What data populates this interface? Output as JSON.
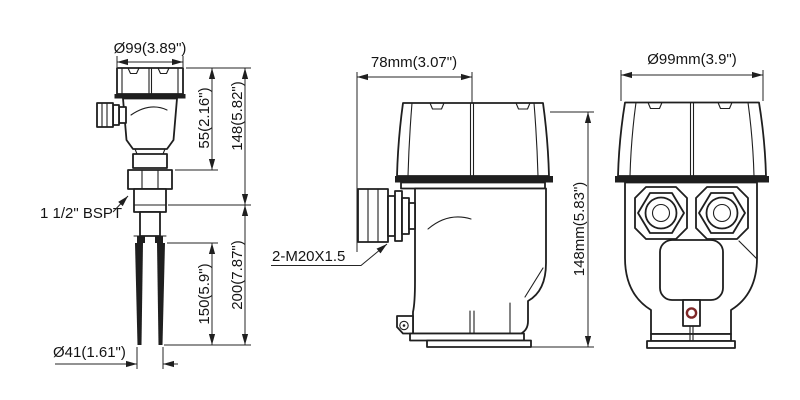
{
  "drawing": {
    "type": "engineering-dimension-drawing",
    "subject": "tuning-fork level switch, three orthographic views",
    "colors": {
      "line": "#1f1f1f",
      "background": "#ffffff",
      "grommet_ring": "#7e2727"
    }
  },
  "views": {
    "fork_side": {
      "dims": {
        "top_diameter": "Ø99(3.89\")",
        "housing_height": "55(2.16\")",
        "head_total": "148(5.82\")",
        "fork_length": "150(5.9\")",
        "insert_length": "200(7.87\")",
        "fork_width": "Ø41(1.61\")"
      },
      "labels": {
        "thread": "1 1/2\" BSPT"
      }
    },
    "housing_side": {
      "dims": {
        "width": "78mm(3.07\")",
        "height": "148mm(5.83\")"
      },
      "labels": {
        "gland": "2-M20X1.5"
      }
    },
    "housing_front": {
      "dims": {
        "width": "Ø99mm(3.9\")"
      }
    }
  }
}
